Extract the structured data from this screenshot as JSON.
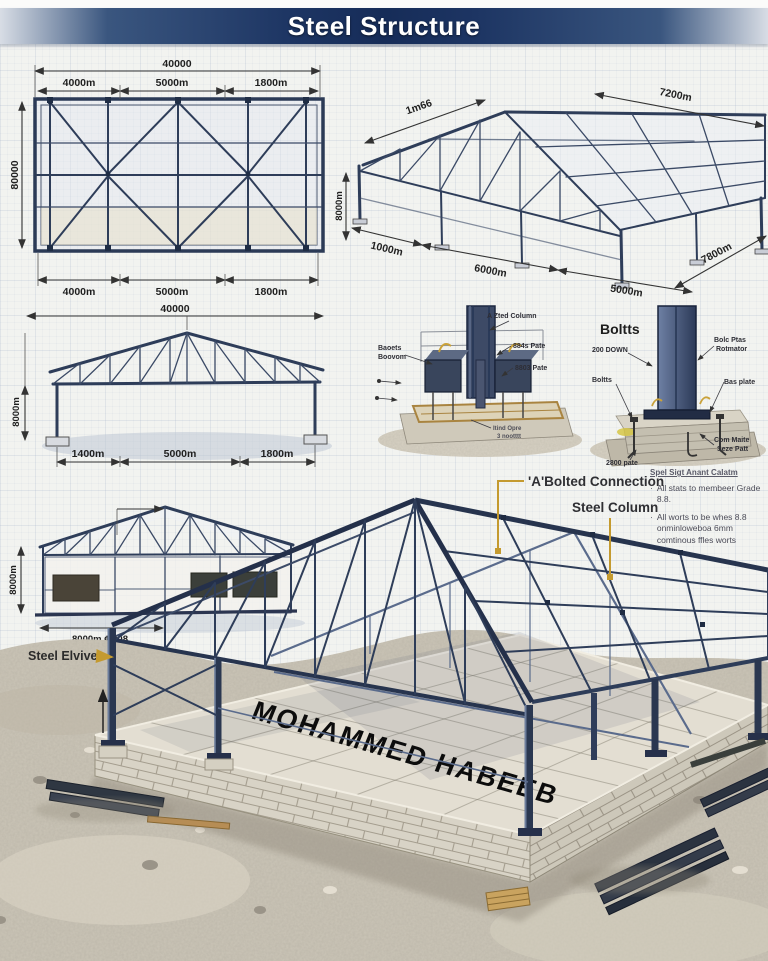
{
  "title": "Steel Structure",
  "plan_view": {
    "dim_overall": "40000",
    "top": [
      "4000m",
      "5000m",
      "1800m"
    ],
    "bottom": [
      "4000m",
      "5000m",
      "1800m"
    ],
    "dim_left": "80000"
  },
  "iso_view": {
    "dim_slope": "1m66",
    "dim_top_right": "7200m",
    "dim_left": "8000m",
    "bottom": [
      "1000m",
      "6000m",
      "5000m"
    ],
    "dim_right": "7800m"
  },
  "truss_view": {
    "dim_overall": "40000",
    "bottom": [
      "1400m",
      "5000m",
      "1800m"
    ],
    "dim_left": "8000m"
  },
  "base_detail": {
    "label_bolts_1": "Baoets",
    "label_bolts_2": "Boovom",
    "label_column": "A Zted Column",
    "label_plate1": "884s Pate",
    "label_plate2": "8803 Pate",
    "label_note_1": "Itind Opre",
    "label_note_2": "3 nootttt"
  },
  "bolts_detail": {
    "title": "Boltts",
    "label_down": "200 DOWN",
    "label_bolts": "Boltts",
    "label_plan_1": "Bolc Ptas",
    "label_plan_2": "Rotmator",
    "label_base": "Bas plate",
    "label_plate": "2800 pate",
    "label_conc_1": "Com Maite",
    "label_conc_2": "Seze Patt"
  },
  "callouts": {
    "bolted_connection": "'A'Bolted Connection",
    "steel_column": "Steel Column"
  },
  "notes": {
    "heading": "Spel Sigt Anant Calatm",
    "item1": "All stats to membeer Grade 8.8.",
    "item2": "All worts to be whes 8.8 onminloweboa 6mm comtinous ffles worts"
  },
  "elevation_view": {
    "dim_left": "8000m",
    "dim_bottom": "8000m ¢ 008",
    "label": "Steel Elviven"
  },
  "render": {
    "watermark": "MOHAMMED HABEEB"
  },
  "colors": {
    "banner": "#1d3563",
    "steel": "#2e3d59",
    "gold": "#c49a2f",
    "paper": "#f2f3f0"
  }
}
